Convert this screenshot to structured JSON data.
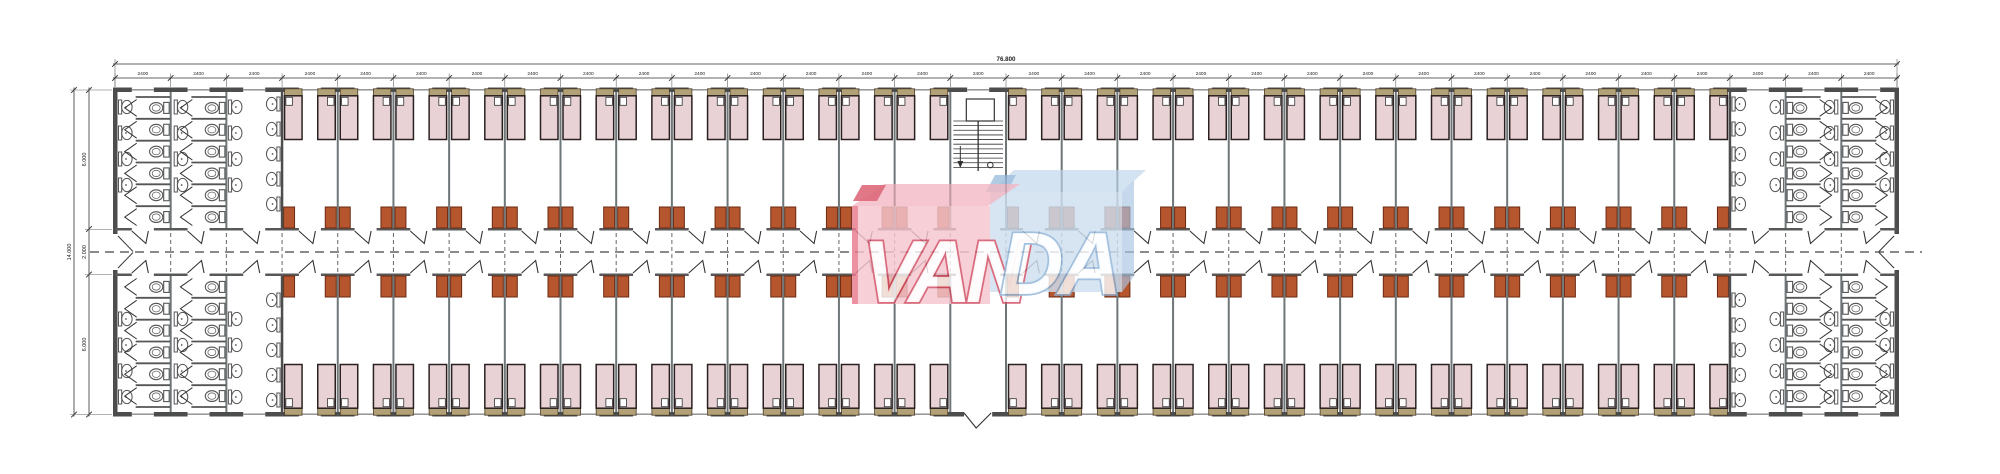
{
  "drawing": {
    "type": "architectural-floor-plan",
    "dimensions_top": {
      "total_label": "76.800",
      "bay_label": "2400",
      "bay_count": 32
    },
    "dimensions_left": {
      "total_label": "14.000",
      "segment_labels": [
        "6.000",
        "2.000",
        "6.000"
      ]
    },
    "layout": {
      "bathroom_bays_each_end": 3,
      "stair_bay_index": 15,
      "entrance_bay_index": 15,
      "toilet_stalls_per_column": 6,
      "sinks_per_wall": 4,
      "room_bays_start": 3,
      "room_bays_end": 28
    },
    "logo": {
      "left_text": "VAN",
      "right_text": "DA",
      "left_box_color": "#f5c6ce",
      "left_top_color": "#f0a9b6",
      "left_accent_color": "#d5495e",
      "left_outline_color": "#d04b62",
      "right_box_color": "#cfe0f1",
      "right_top_color": "#bdd5ec",
      "right_side_color": "#a9c4e2",
      "right_accent_color": "#8fb4d8",
      "right_outline_color": "#8fb4d8",
      "letter_fill": "#ffffff"
    },
    "colors": {
      "background": "#ffffff",
      "wall": "#4d4d4d",
      "partition": "#6e7678",
      "bed_fill": "#e8d2d6",
      "bed_border": "#2a2020",
      "headboard_fill": "#b2a176",
      "headboard_border": "#4a3c28",
      "pillow_fill": "#ffffff",
      "desk_fill": "#b5562f",
      "desk_border": "#6b2a12",
      "fixture_stroke": "#555555",
      "door_stroke": "#333333",
      "stair_stroke": "#333333",
      "dim_line": "#333333",
      "dim_text": "#222222",
      "centerline": "#444444",
      "window_line": "#8a8a8a"
    }
  }
}
